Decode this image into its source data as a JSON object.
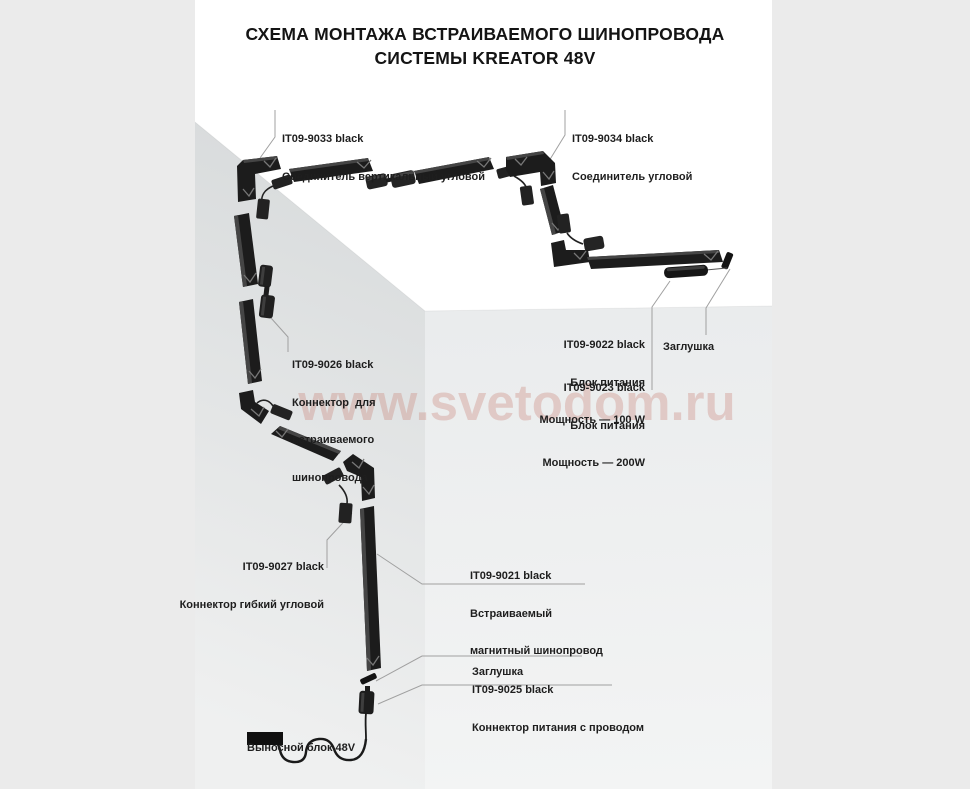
{
  "title": {
    "line1": "СХЕМА МОНТАЖА ВСТРАИВАЕМОГО ШИНОПРОВОДА",
    "line2": "СИСТЕМЫ KREATOR 48V"
  },
  "watermark": "www.svetodom.ru",
  "colors": {
    "margin": "#ebebeb",
    "page": "#ffffff",
    "wall_left_dark": "#d8dbdc",
    "wall_left_light": "#eff0f0",
    "wall_front_top": "#eaeced",
    "wall_front_bottom": "#f3f4f4",
    "track": "#1c1c1c",
    "track_highlight": "#454545",
    "leader": "#a0a0a0",
    "watermark": "rgba(200,124,112,0.32)",
    "text": "#1e1e1e"
  },
  "labels": {
    "connector_vertical_corner": {
      "code": "IT09-9033 black",
      "desc": "Соединитель вертикальный угловой"
    },
    "connector_corner": {
      "code": "IT09-9034 black",
      "desc": "Соединитель угловой"
    },
    "connector_recessed": {
      "code": "IT09-9026 black",
      "desc_lines": [
        "Коннектор  для",
        "встраиваемого",
        "шинопровода"
      ]
    },
    "connector_flexible": {
      "code": "IT09-9027 black",
      "desc": "Коннектор гибкий угловой"
    },
    "track_recessed": {
      "code": "IT09-9021 black",
      "desc_lines": [
        "Встраиваемый",
        "магнитный шинопровод"
      ]
    },
    "psu_100": {
      "code": "IT09-9022 black",
      "desc_lines": [
        "Блок питания",
        "Мощность — 100 W"
      ]
    },
    "psu_200": {
      "code": "IT09-9023 black",
      "desc_lines": [
        "Блок питания",
        "Мощность — 200W"
      ]
    },
    "end_cap_right": {
      "text": "Заглушка"
    },
    "end_cap_bottom": {
      "text": "Заглушка"
    },
    "power_connector": {
      "code": "IT09-9025 black",
      "desc": "Коннектор питания с проводом"
    },
    "remote_block": {
      "text": "Выносной блок 48V"
    }
  }
}
